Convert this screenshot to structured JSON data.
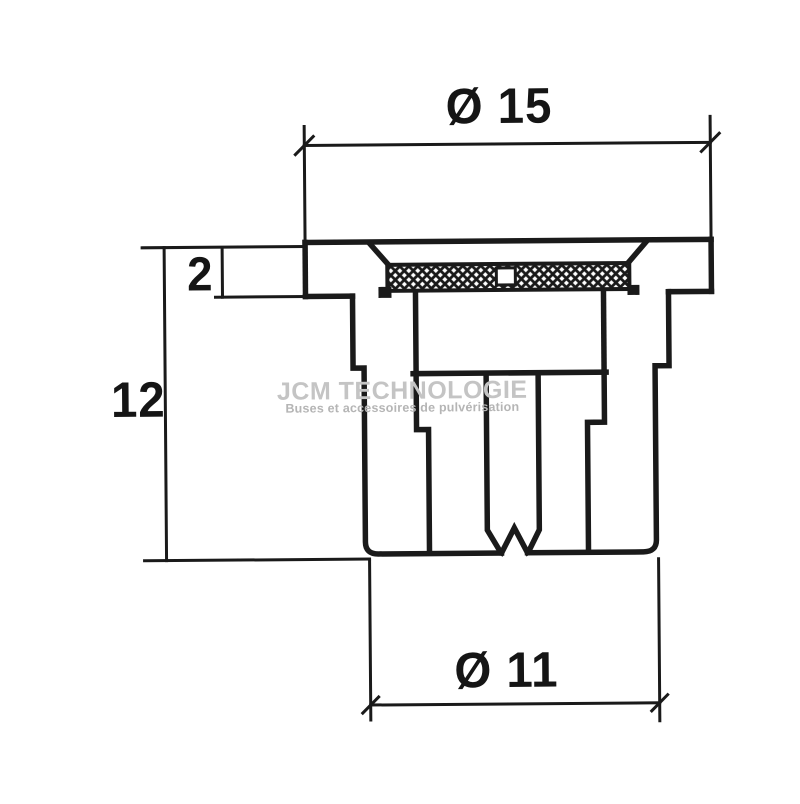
{
  "background_color": "#ffffff",
  "line_color": "#1a1a1a",
  "drawing": {
    "dimension_labels": {
      "top_diameter": "Ø 15",
      "flange_thickness": "2",
      "overall_height": "12",
      "bottom_diameter": "Ø 11"
    },
    "watermark": {
      "title": "JCM TECHNOLOGIE",
      "subtitle": "Buses et accessoires de pulvérisation",
      "title_color": "#c4c4c4",
      "subtitle_color": "#b5b5b5"
    }
  }
}
